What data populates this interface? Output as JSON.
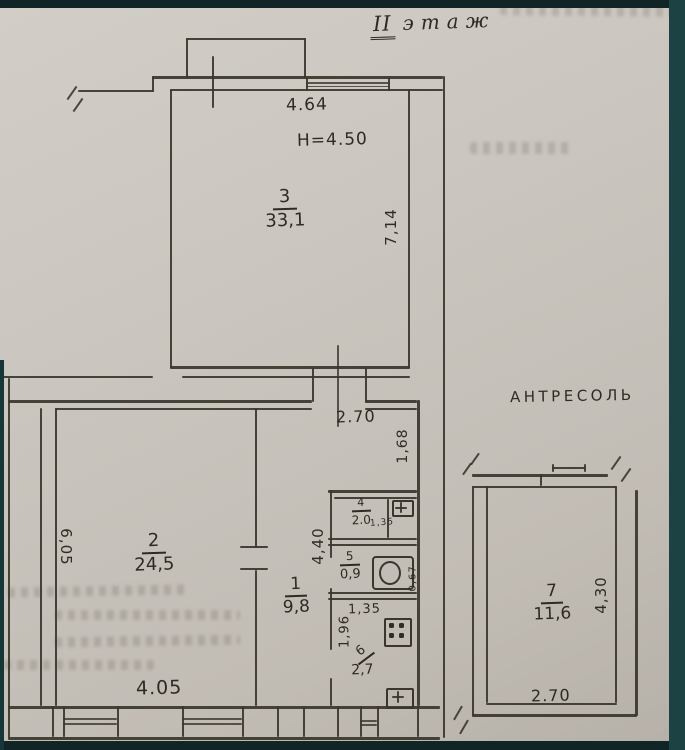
{
  "title": {
    "numeral": "II",
    "word": "этаж"
  },
  "labels": {
    "mezzanine": "АНТРЕСОЛЬ"
  },
  "dims": {
    "top_width": "4.64",
    "ceiling_height": "H=4.50",
    "room3_side": "7,14",
    "vestibule_width": "2.70",
    "niche": "1,68",
    "room2_side": "6,05",
    "room2_width": "4.05",
    "column": "4,40",
    "room4_small": "1,35",
    "wc_side": "0,67",
    "kitchen_width": "1,35",
    "kitchen_side": "1,96",
    "room7_side": "4,30",
    "room7_width": "2.70"
  },
  "rooms": {
    "r1": {
      "number": "1",
      "area": "9,8"
    },
    "r2": {
      "number": "2",
      "area": "24,5"
    },
    "r3": {
      "number": "3",
      "area": "33,1"
    },
    "r4": {
      "number": "4",
      "area": "2.0"
    },
    "r5": {
      "number": "5",
      "area": "0,9"
    },
    "r6": {
      "number": "6",
      "area": "2,7"
    },
    "r7": {
      "number": "7",
      "area": "11,6"
    }
  }
}
